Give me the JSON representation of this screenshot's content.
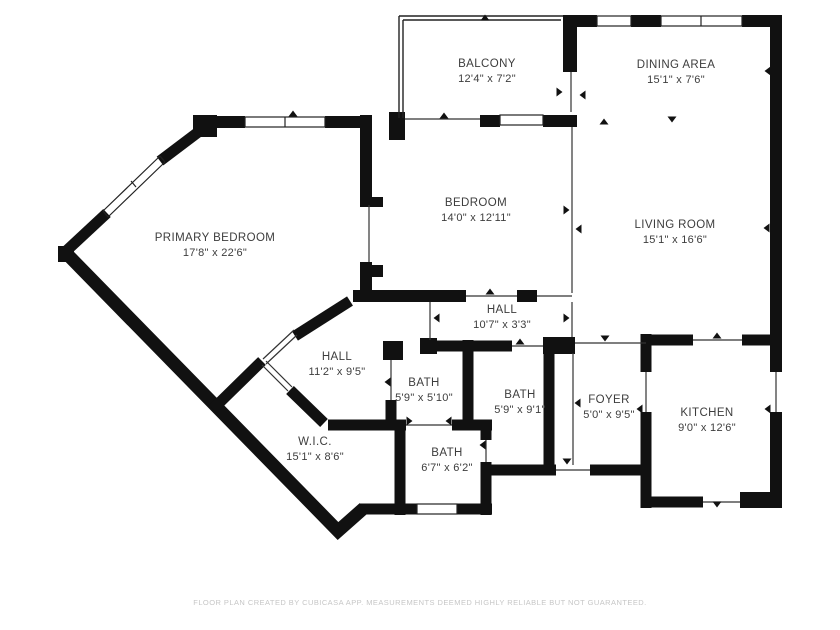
{
  "rooms": {
    "balcony": {
      "name": "BALCONY",
      "dims": "12'4\" x 7'2\""
    },
    "dining": {
      "name": "DINING AREA",
      "dims": "15'1\" x 7'6\""
    },
    "bedroom": {
      "name": "BEDROOM",
      "dims": "14'0\" x 12'11\""
    },
    "living": {
      "name": "LIVING ROOM",
      "dims": "15'1\" x 16'6\""
    },
    "primary": {
      "name": "PRIMARY BEDROOM",
      "dims": "17'8\" x 22'6\""
    },
    "hall_upper": {
      "name": "HALL",
      "dims": "10'7\" x 3'3\""
    },
    "hall_lower": {
      "name": "HALL",
      "dims": "11'2\" x 9'5\""
    },
    "bath_small": {
      "name": "BATH",
      "dims": "5'9\" x 5'10\""
    },
    "bath_mid": {
      "name": "BATH",
      "dims": "5'9\" x 9'1\""
    },
    "foyer": {
      "name": "FOYER",
      "dims": "5'0\" x 9'5\""
    },
    "kitchen": {
      "name": "KITCHEN",
      "dims": "9'0\" x 12'6\""
    },
    "wic": {
      "name": "W.I.C.",
      "dims": "15'1\" x 8'6\""
    },
    "bath_lower": {
      "name": "BATH",
      "dims": "6'7\" x 6'2\""
    }
  },
  "footer": {
    "disclaimer": "FLOOR PLAN CREATED BY CUBICASA APP. MEASUREMENTS DEEMED HIGHLY RELIABLE BUT NOT GUARANTEED."
  },
  "colors": {
    "wall": "#111111",
    "label_text": "#3d3d3d",
    "footer_text": "#c6c6c6",
    "background": "#ffffff"
  }
}
